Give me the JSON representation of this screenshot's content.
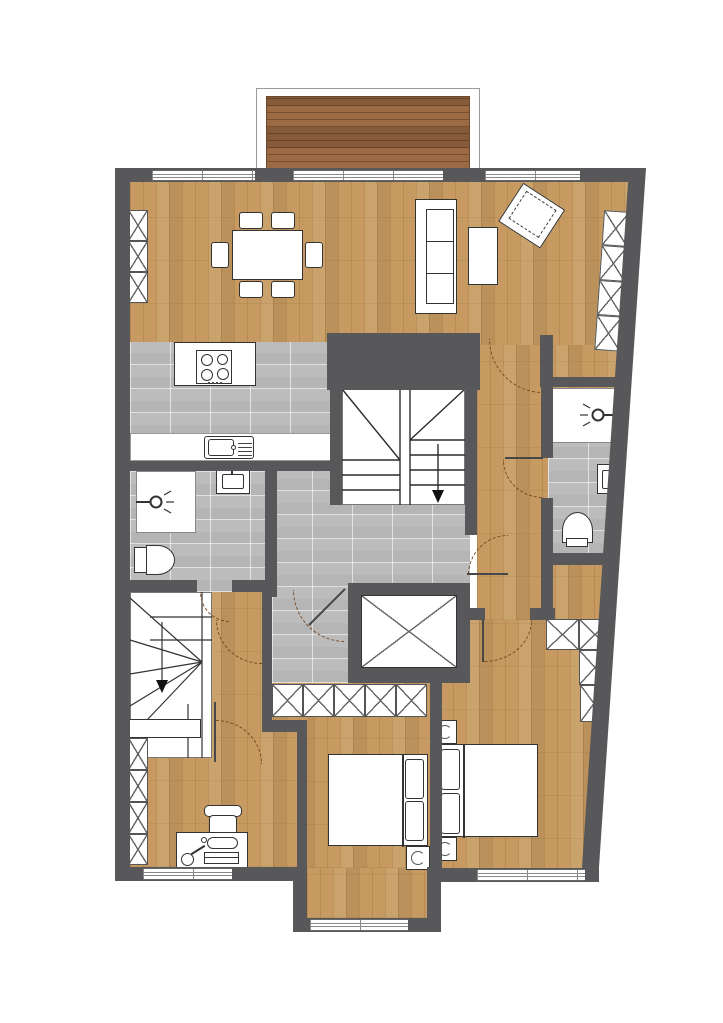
{
  "document": {
    "type": "architectural-floor-plan",
    "title": "Apartment floor plan",
    "view": "top-down"
  },
  "palette": {
    "wall": "#58585a",
    "wood": "#c69a60",
    "tile": "#bcbcbc",
    "deck": "#9c6a44",
    "outline": "#333333",
    "arc": "#7a4a22",
    "white": "#ffffff"
  },
  "rooms": [
    {
      "name": "living-dining-room",
      "floor": "wood",
      "furniture": [
        "dining-table",
        "six-dining-chairs",
        "three-seat-sofa",
        "coffee-table",
        "armchair",
        "shelf-unit-left",
        "wardrobe-right"
      ]
    },
    {
      "name": "kitchen",
      "floor": "tile",
      "fixtures": [
        "cooktop-4-burners",
        "counter-with-sink"
      ]
    },
    {
      "name": "bathroom-west",
      "floor": "tile",
      "fixtures": [
        "shower",
        "washbasin",
        "toilet"
      ]
    },
    {
      "name": "bathroom-east",
      "floor": "tile",
      "fixtures": [
        "shower",
        "washbasin",
        "toilet"
      ]
    },
    {
      "name": "hallway",
      "floor": "tile",
      "features": [
        "main-staircase",
        "elevator",
        "closet-row"
      ]
    },
    {
      "name": "entry-hall",
      "floor": "wood"
    },
    {
      "name": "secondary-staircase",
      "floor": "none"
    },
    {
      "name": "office",
      "floor": "wood",
      "furniture": [
        "desk",
        "office-chair",
        "desk-lamp",
        "wardrobe-column",
        "dresser"
      ]
    },
    {
      "name": "bedroom-south",
      "floor": "wood",
      "furniture": [
        "double-bed",
        "nightstand-with-lamp",
        "closet-row"
      ]
    },
    {
      "name": "bedroom-east",
      "floor": "wood",
      "furniture": [
        "double-bed",
        "nightstand-with-lamp-top",
        "nightstand-with-lamp-bottom",
        "l-shaped-wardrobe"
      ]
    },
    {
      "name": "balcony",
      "floor": "wood-deck"
    }
  ],
  "openings": {
    "windows_top": 3,
    "windows_bottom": 3,
    "doors_with_swing_arcs": 8
  },
  "stairs": [
    {
      "name": "main-staircase",
      "direction_arrow": "down"
    },
    {
      "name": "secondary-staircase",
      "direction_arrow": "down"
    }
  ],
  "icons": [
    "shower-head-icon",
    "toilet-icon",
    "washbasin-icon",
    "cooktop-icon",
    "sink-icon",
    "stairs-down-arrow-icon",
    "elevator-x-icon",
    "wardrobe-x-icon",
    "table-lamp-icon",
    "desk-lamp-icon"
  ]
}
